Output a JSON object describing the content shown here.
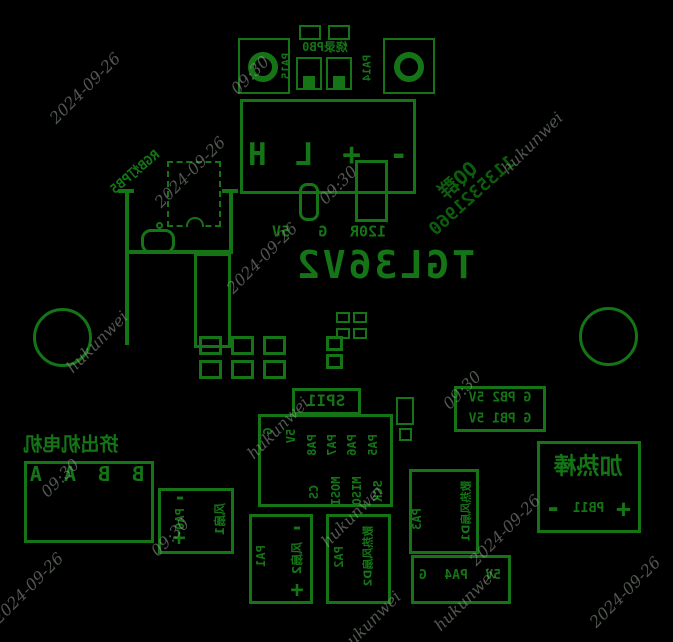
{
  "board": {
    "part_number": "TGL36V2",
    "qq": {
      "line1": "QQ群",
      "line2": "1135321960"
    },
    "prog": {
      "label": "烧录PB0",
      "pad_left": "PA15",
      "pad_right": "PA14"
    },
    "can": {
      "pins": [
        "-",
        "+",
        "L",
        "H"
      ]
    },
    "r_row": {
      "r": "120R",
      "g": "G",
      "v": "5V"
    },
    "rgb_label": "RGB灯PB5",
    "spi": {
      "title": "SPI1",
      "top": [
        "PA5",
        "PA6",
        "PA7",
        "PA8",
        "5V",
        "G"
      ],
      "bottom": [
        "SCK",
        "MISO",
        "MOSI",
        "CS"
      ]
    },
    "pb_header": {
      "row1": "G PB2 5V",
      "row2": "G PB1 5V"
    },
    "heater": {
      "title": "加热棒",
      "plus": "+",
      "pin": "PB11",
      "minus": "-"
    },
    "extruder": {
      "title": "挤出机电机",
      "pins": "B B A A"
    },
    "fan1": {
      "minus": "-",
      "pin": "PA0",
      "plus": "+",
      "label": "风扇1"
    },
    "fan2": {
      "pin": "PA1",
      "minus": "-",
      "label": "风扇2",
      "plus": "+"
    },
    "fan3": {
      "pin": "PA2",
      "label": "散热风扇D2"
    },
    "fan4": {
      "pin": "PA3",
      "label": "散热风扇D1"
    },
    "pa4_header": {
      "v": "5V",
      "pin": "PA4",
      "g": "G"
    },
    "silk_color": "#147416"
  },
  "watermarks": [
    {
      "text": "2024-09-26",
      "x": 85,
      "y": 88
    },
    {
      "text": "09:30",
      "x": 250,
      "y": 75
    },
    {
      "text": "hukunwei",
      "x": 532,
      "y": 143
    },
    {
      "text": "2024-09-26",
      "x": 190,
      "y": 172
    },
    {
      "text": "09:30",
      "x": 338,
      "y": 185
    },
    {
      "text": "2024-09-26",
      "x": 262,
      "y": 258
    },
    {
      "text": "hukunwei",
      "x": 97,
      "y": 342
    },
    {
      "text": "hukunwei",
      "x": 278,
      "y": 428
    },
    {
      "text": "09:30",
      "x": 462,
      "y": 390
    },
    {
      "text": "09:30",
      "x": 60,
      "y": 478
    },
    {
      "text": "2024-09-26",
      "x": 505,
      "y": 530
    },
    {
      "text": "hukunwei",
      "x": 352,
      "y": 516
    },
    {
      "text": "2024-09-26",
      "x": 28,
      "y": 588
    },
    {
      "text": "09:30",
      "x": 170,
      "y": 537
    },
    {
      "text": "hukunwei",
      "x": 370,
      "y": 622
    },
    {
      "text": "hukunwei",
      "x": 465,
      "y": 600
    },
    {
      "text": "2024-09-26",
      "x": 625,
      "y": 592
    }
  ]
}
